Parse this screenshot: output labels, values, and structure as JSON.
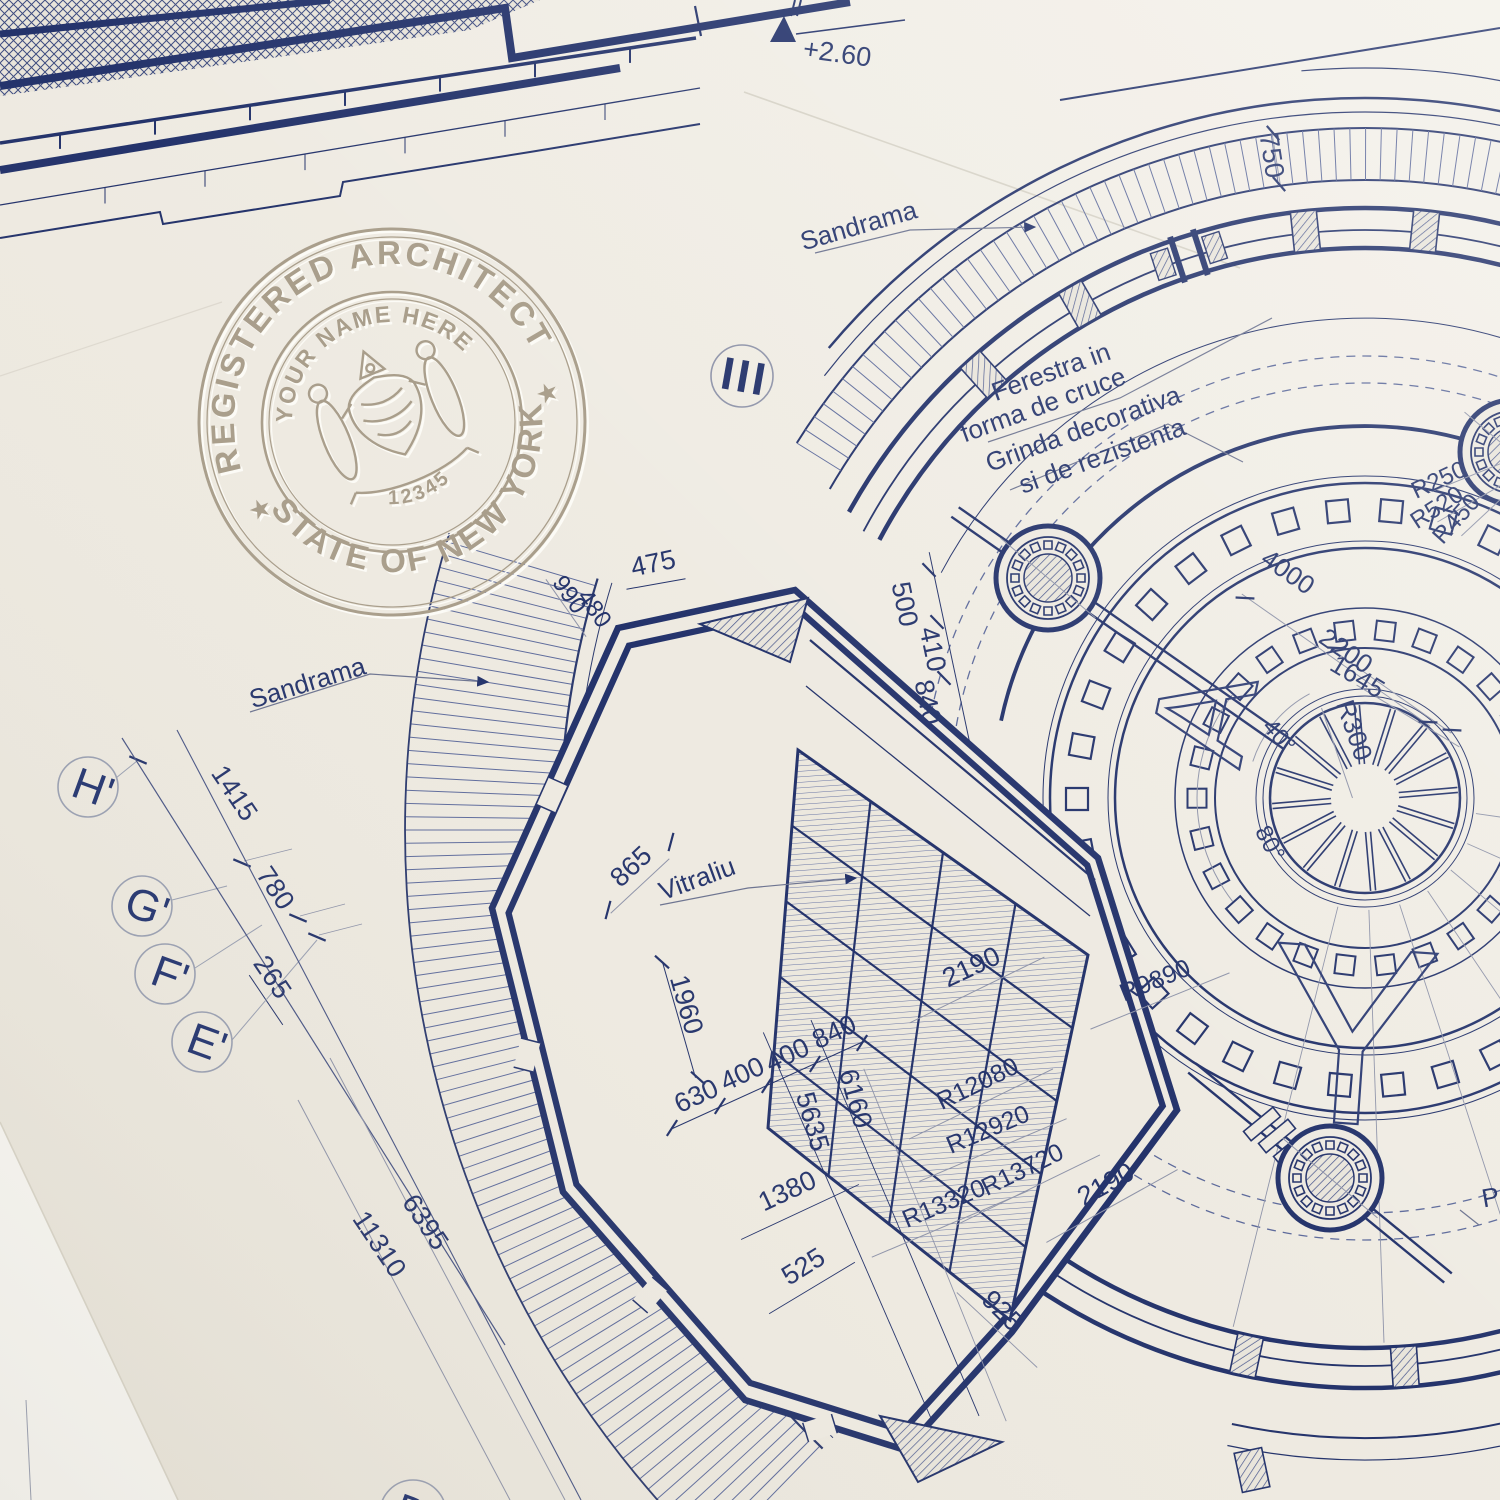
{
  "seal": {
    "ring_top": "REGISTERED ARCHITECT",
    "ring_bottom": "STATE OF NEW YORK",
    "name_line": "YOUR NAME HERE",
    "license_number": "12345",
    "star": "★"
  },
  "annotations": {
    "elevation": "+2.60",
    "section_marker": "III",
    "sandrama_top": "Sandrama",
    "sandrama_left": "Sandrama",
    "window_note_line1": "Ferestra in",
    "window_note_line2": "forma de cruce",
    "beam_note_line1": "Grinda decorativa",
    "beam_note_line2": "si de rezistenta",
    "stained_glass": "Vitraliu",
    "watermark_letter_a": "A",
    "watermark_letter_y": "Y",
    "partial_label": "P"
  },
  "axis_bubbles": {
    "h": "H'",
    "g": "G'",
    "f": "F'",
    "e": "E'",
    "d": "D'"
  },
  "dimensions": {
    "v475": "475",
    "v990": "990",
    "v480": "480",
    "v500": "500",
    "v410": "410",
    "v840a": "840",
    "v840b": "840",
    "v750": "750",
    "v4000": "4000",
    "v2200": "2200",
    "v1645": "1645",
    "r300": "R300",
    "a40": "40°",
    "a80": "80°",
    "r250": "R250",
    "r520": "R520",
    "r450": "R450",
    "v865": "865",
    "v1960": "1960",
    "v630": "630",
    "v400a": "400",
    "v400b": "400",
    "v5635": "5635",
    "v6160": "6160",
    "v1380": "1380",
    "v525": "525",
    "v925": "925",
    "v2190a": "2190",
    "v2190b": "2190",
    "r12080": "R12080",
    "r12920": "R12920",
    "r13720": "R13720",
    "r13320": "R13320",
    "r9890": "R9890",
    "v1415": "1415",
    "v780": "780",
    "v265": "265",
    "v6395": "6395",
    "v11310": "11310"
  },
  "colors": {
    "ink": "#24336b",
    "hatch": "#5f6c9c",
    "dim_gray": "#8f94a9",
    "paper": "#eeeae1",
    "emboss": "#ab9f8c"
  }
}
